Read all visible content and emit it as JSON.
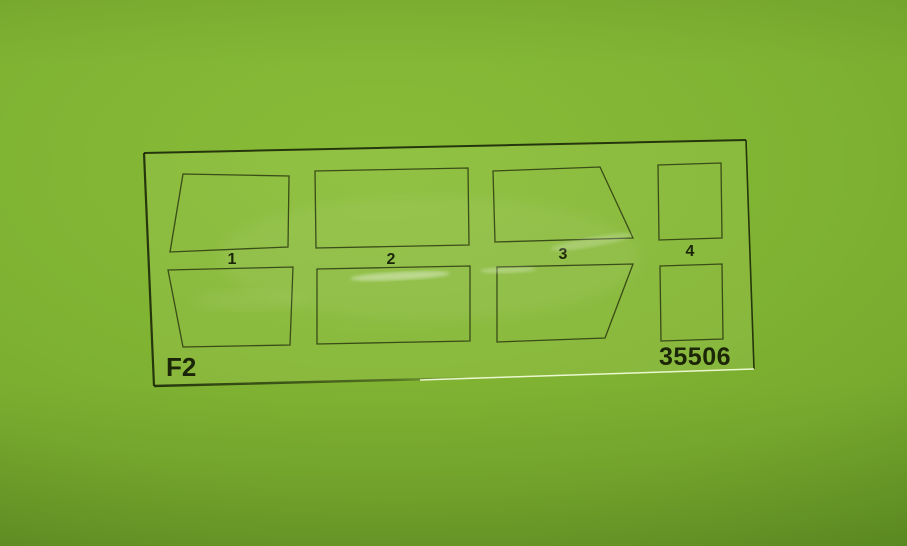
{
  "photo": {
    "film": {
      "sheet_code": "F2",
      "kit_number": "35506",
      "part_numbers": [
        "1",
        "2",
        "3",
        "4"
      ]
    },
    "colors": {
      "background_green": "#7fb232",
      "background_shadow_green": "#598e21",
      "printed_outline": "#27330e",
      "label_text": "#1b2507"
    }
  }
}
